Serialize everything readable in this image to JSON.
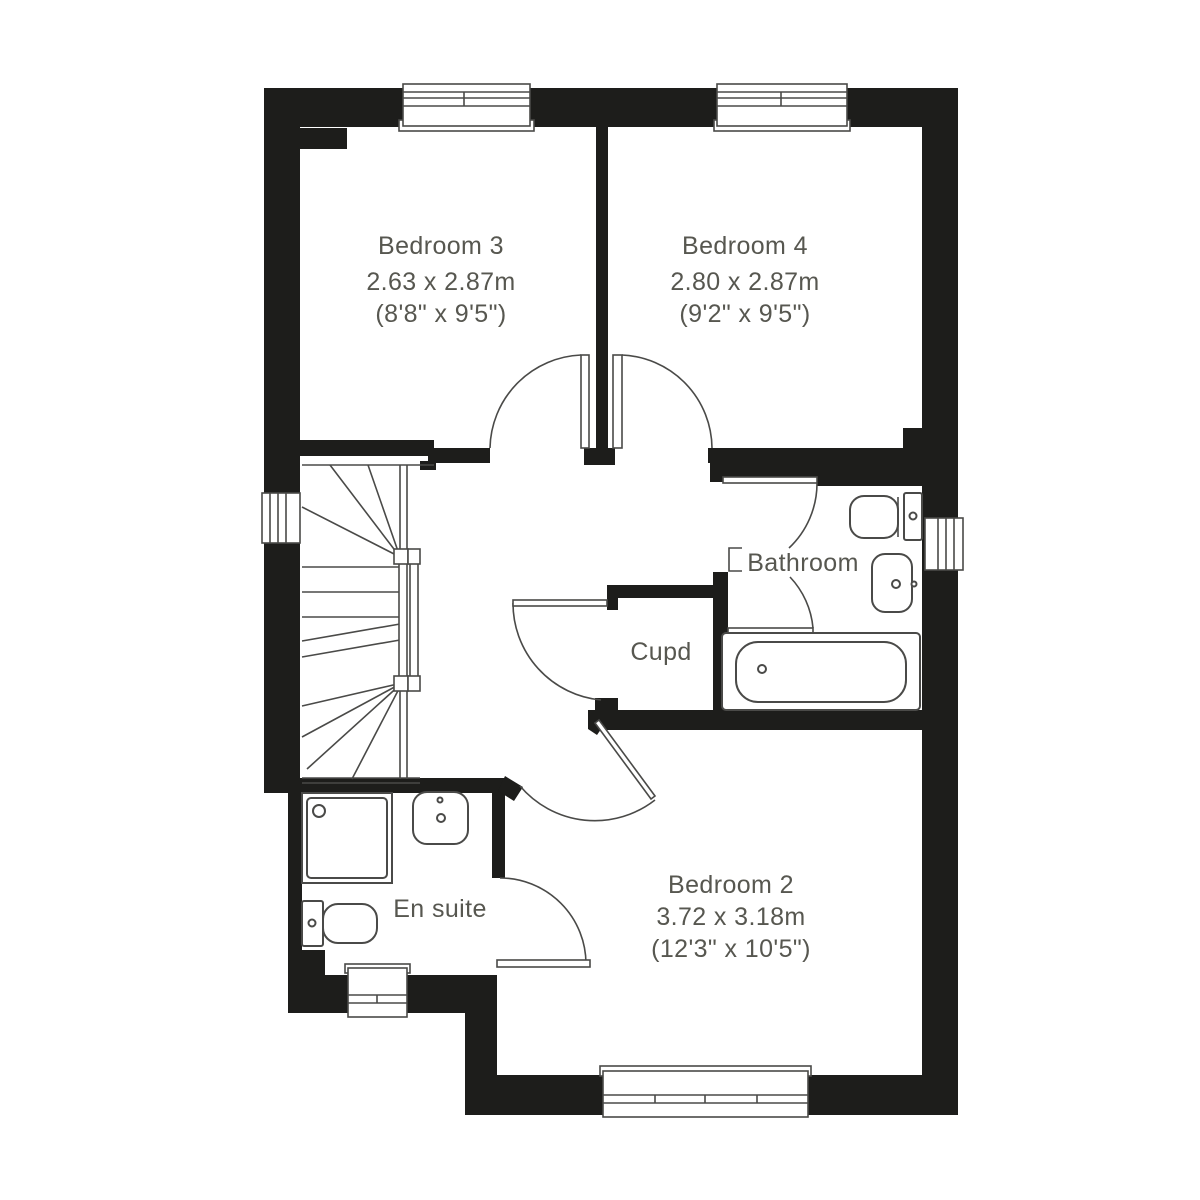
{
  "rooms": {
    "bedroom3": {
      "name": "Bedroom 3",
      "metric": "2.63 x 2.87m",
      "imperial": "(8'8\" x 9'5\")"
    },
    "bedroom4": {
      "name": "Bedroom 4",
      "metric": "2.80 x 2.87m",
      "imperial": "(9'2\" x 9'5\")"
    },
    "bedroom2": {
      "name": "Bedroom 2",
      "metric": "3.72 x 3.18m",
      "imperial": "(12'3\" x 10'5\")"
    },
    "bathroom": {
      "name": "Bathroom"
    },
    "ensuite": {
      "name": "En suite"
    },
    "cupboard": {
      "name": "Cupd"
    }
  },
  "colors": {
    "wall": "#1d1d1b",
    "line": "#4a4a48",
    "text": "#575750"
  }
}
